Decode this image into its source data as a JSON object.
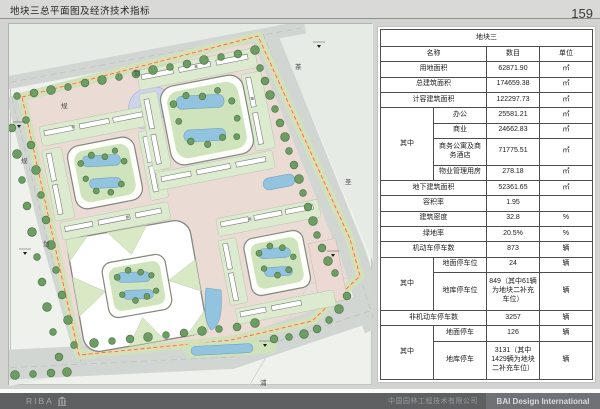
{
  "header": {
    "title": "地块三总平面图及经济技术指标",
    "page_number": "159"
  },
  "map": {
    "road_labels": [
      {
        "text": "规"
      },
      {
        "text": "划"
      },
      {
        "text": "规"
      },
      {
        "text": "划"
      },
      {
        "text": "茶"
      },
      {
        "text": "圣"
      },
      {
        "text": "浦"
      }
    ]
  },
  "table": {
    "title": "地块三",
    "columns": {
      "name": "名称",
      "value": "数目",
      "unit": "单位"
    },
    "subgroup_label": "其中",
    "rows": [
      {
        "name": "用地面积",
        "value": "62871.90",
        "unit": "㎡"
      },
      {
        "name": "总建筑面积",
        "value": "174659.38",
        "unit": "㎡"
      },
      {
        "name": "计容建筑面积",
        "value": "122297.73",
        "unit": "㎡"
      },
      {
        "name": "办公",
        "value": "25581.21",
        "unit": "㎡",
        "group": "A"
      },
      {
        "name": "商业",
        "value": "24662.83",
        "unit": "㎡",
        "group": "A"
      },
      {
        "name": "商务公寓及商务酒店",
        "value": "71775.51",
        "unit": "㎡",
        "group": "A"
      },
      {
        "name": "物业管理用房",
        "value": "278.18",
        "unit": "㎡",
        "group": "A"
      },
      {
        "name": "地下建筑面积",
        "value": "52361.65",
        "unit": "㎡"
      },
      {
        "name": "容积率",
        "value": "1.95",
        "unit": ""
      },
      {
        "name": "建筑密度",
        "value": "32.8",
        "unit": "%"
      },
      {
        "name": "绿地率",
        "value": "20.5%",
        "unit": "%"
      },
      {
        "name": "机动车停车数",
        "value": "873",
        "unit": "辆"
      },
      {
        "name": "地面停车位",
        "value": "24",
        "unit": "辆",
        "group": "B"
      },
      {
        "name": "地库停车位",
        "value": "849（其中61辆为地块二补充车位）",
        "unit": "辆",
        "group": "B"
      },
      {
        "name": "非机动车停车数",
        "value": "3257",
        "unit": "辆"
      },
      {
        "name": "地面停车",
        "value": "126",
        "unit": "辆",
        "group": "C"
      },
      {
        "name": "地库停车",
        "value": "3131（其中1429辆为地块二补充车位）",
        "unit": "辆",
        "group": "C"
      }
    ]
  },
  "footer": {
    "logo": "RIBA",
    "company": "中国园林工程技术有限公司",
    "brand": "BAI Design International"
  }
}
